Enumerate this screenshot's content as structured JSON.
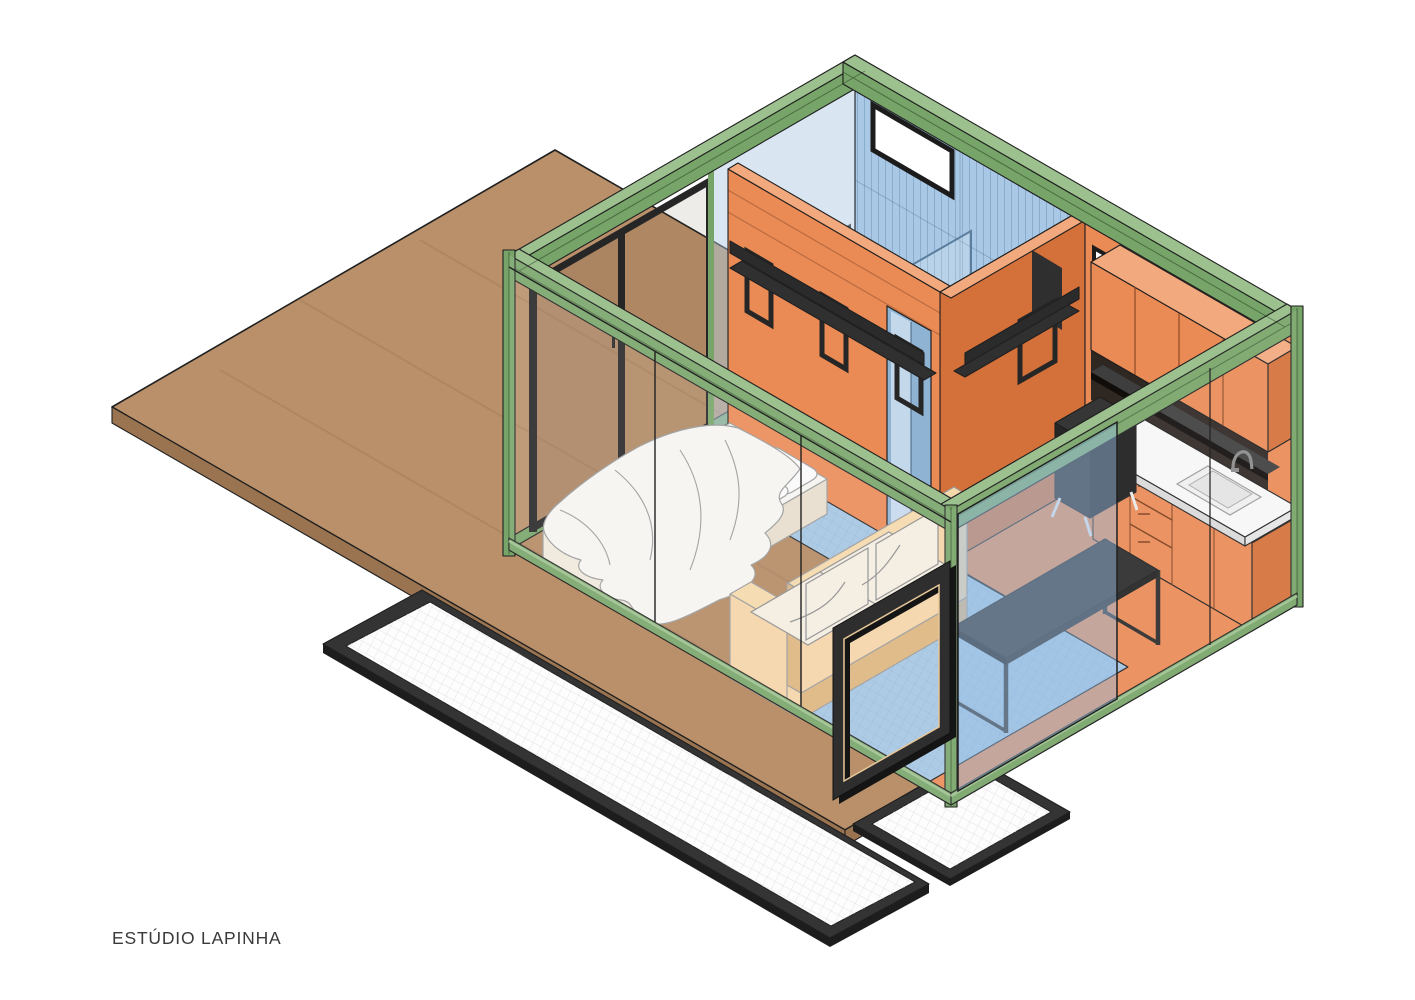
{
  "label": {
    "text": "ESTÚDIO LAPINHA"
  },
  "colors": {
    "background": "#ffffff",
    "deck_top": "#b9906a",
    "deck_side": "#9a7450",
    "frame_green": "#77a468",
    "frame_green_light": "#9dc08f",
    "frame_green_dark": "#2d4a28",
    "wall_orange": "#ea8a55",
    "wall_orange_dark": "#d4703a",
    "wall_orange_light": "#f2a97e",
    "wall_blue": "#a9c8e5",
    "floor_blue": "#a5c6e3",
    "metal_black": "#2b2b2b",
    "metal_black_top": "#3e3e3e",
    "counter_white": "#f7f7f7",
    "bed_white": "#f5f4f1",
    "sofa_wood": "#f4d4a6",
    "sofa_wood_dark": "#ddb57e",
    "sofa_cushion": "#f3ece0",
    "paving_white": "#fdfdfd",
    "paving_grid": "#dcdcdc",
    "outline_dark": "#1f1f1f",
    "outline_soft": "#9a9a9a",
    "glass_blue": "rgba(150,190,230,0.45)",
    "glass_tint": "rgba(90,65,40,0.14)"
  }
}
